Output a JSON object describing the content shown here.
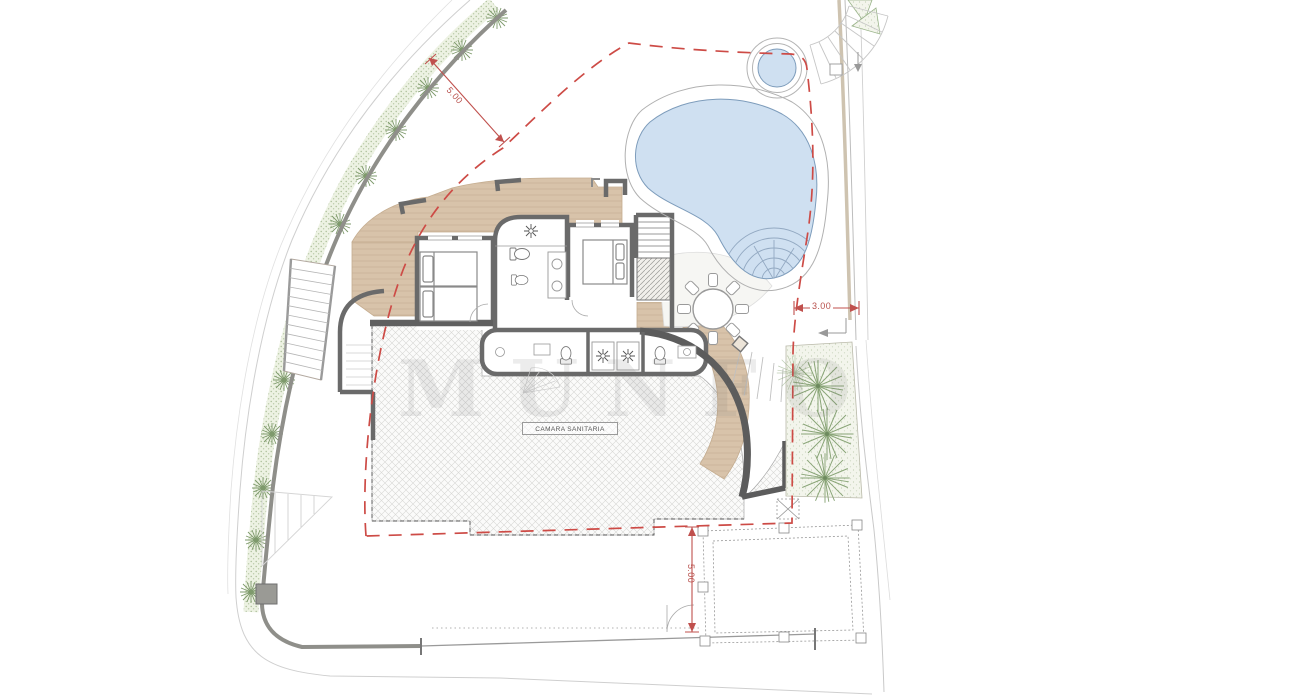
{
  "annotations": {
    "dimension_top_left": "5.00",
    "dimension_right": "3.00",
    "dimension_bottom": "5.00",
    "room_label": "CAMARA SANITARIA",
    "watermark": "MUNFO"
  },
  "colors": {
    "setback_line_red": "#cd4b46",
    "dimension_red": "#b8504c",
    "pool_water_blue": "#cfe0f1",
    "terrace_tan": "#d8c3aa",
    "wall_gray": "#6a6a6a",
    "landscaping_green": "#8aa578",
    "hatch_gray": "#d7d7d5"
  }
}
